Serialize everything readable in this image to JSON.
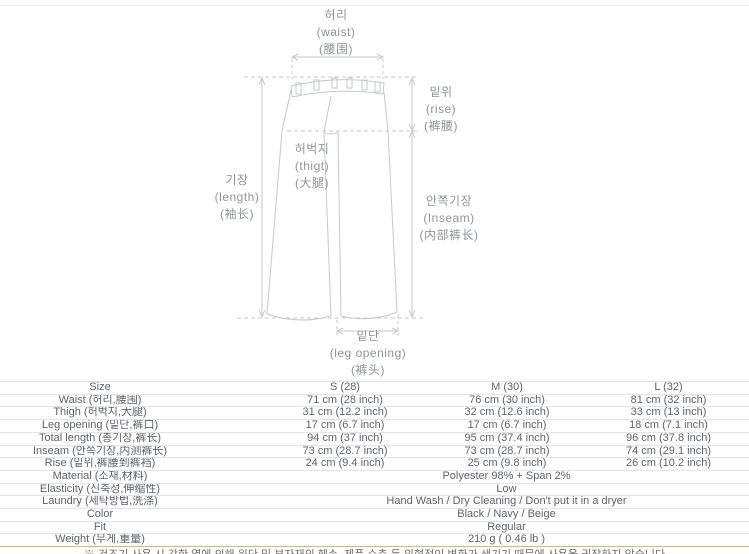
{
  "diagram": {
    "labels": {
      "waist": {
        "ko": "허리",
        "en": "(waist)",
        "zh": "(腰围)"
      },
      "rise": {
        "ko": "밑위",
        "en": "(rise)",
        "zh": "(裤腰)"
      },
      "thigh": {
        "ko": "허벅지",
        "en": "(thigt)",
        "zh": "(大腿)"
      },
      "length": {
        "ko": "기장",
        "en": "(length)",
        "zh": "(袖长)"
      },
      "inseam": {
        "ko": "안쪽기장",
        "en": "(Inseam)",
        "zh": "(内部裤长)"
      },
      "leg_opening": {
        "ko": "밑단",
        "en": "(leg opening)",
        "zh": "(裤头)"
      }
    }
  },
  "size_table": {
    "columns": [
      "Size",
      "S (28)",
      "M (30)",
      "L (32)"
    ],
    "rows": [
      {
        "label": "Waist (허리,腰围)",
        "values": [
          "71 cm (28 inch)",
          "76 cm (30 inch)",
          "81 cm (32 inch)"
        ]
      },
      {
        "label": "Thigh (허벅지,大腿)",
        "values": [
          "31 cm (12.2 inch)",
          "32 cm (12.6 inch)",
          "33 cm (13 inch)"
        ]
      },
      {
        "label": "Leg opening (밑단,裤口)",
        "values": [
          "17 cm (6.7 inch)",
          "17 cm (6.7 inch)",
          "18 cm (7.1 inch)"
        ]
      },
      {
        "label": "Total length (총기장,裤长)",
        "values": [
          "94 cm (37 inch)",
          "95 cm (37.4 inch)",
          "96 cm (37.8 inch)"
        ]
      },
      {
        "label": "Inseam (안쪽기장,内测裤长)",
        "values": [
          "73 cm (28.7 inch)",
          "73 cm (28.7 inch)",
          "74 cm (29.1 inch)"
        ]
      },
      {
        "label": "Rise (밑위,裤腰到裤裆)",
        "values": [
          "24 cm (9.4 inch)",
          "25 cm (9.8 inch)",
          "26 cm (10.2 inch)"
        ]
      }
    ],
    "spanning_rows": [
      {
        "label": "Material (소재,材料)",
        "value": "Polyester 98% + Span 2%"
      },
      {
        "label": "Elasticity (신축성,伸缩性)",
        "value": "Low"
      },
      {
        "label": "Laundry (세탁방법,洗涤)",
        "value": "Hand Wash / Dry Cleaning / Don't put it in a dryer"
      },
      {
        "label": "Color",
        "value": "Black / Navy / Beige"
      },
      {
        "label": "Fit",
        "value": "Regular"
      },
      {
        "label": "Weight (무게,重量)",
        "value": "210 g ( 0.46 lb )"
      }
    ],
    "footnote": "※ 건조기 사용 시 강한 열에 의해 원단 및 부자재의 훼손, 제품 수축 등 외형적인 변화가 생기기 때문에 사용을 권장하지 않습니다"
  },
  "colors": {
    "diagram_line": "#c6c8ca",
    "diagram_label": "#919497",
    "table_text": "#606366",
    "row_border": "#e4e4e4",
    "table_bottom_border": "#cbb992"
  }
}
